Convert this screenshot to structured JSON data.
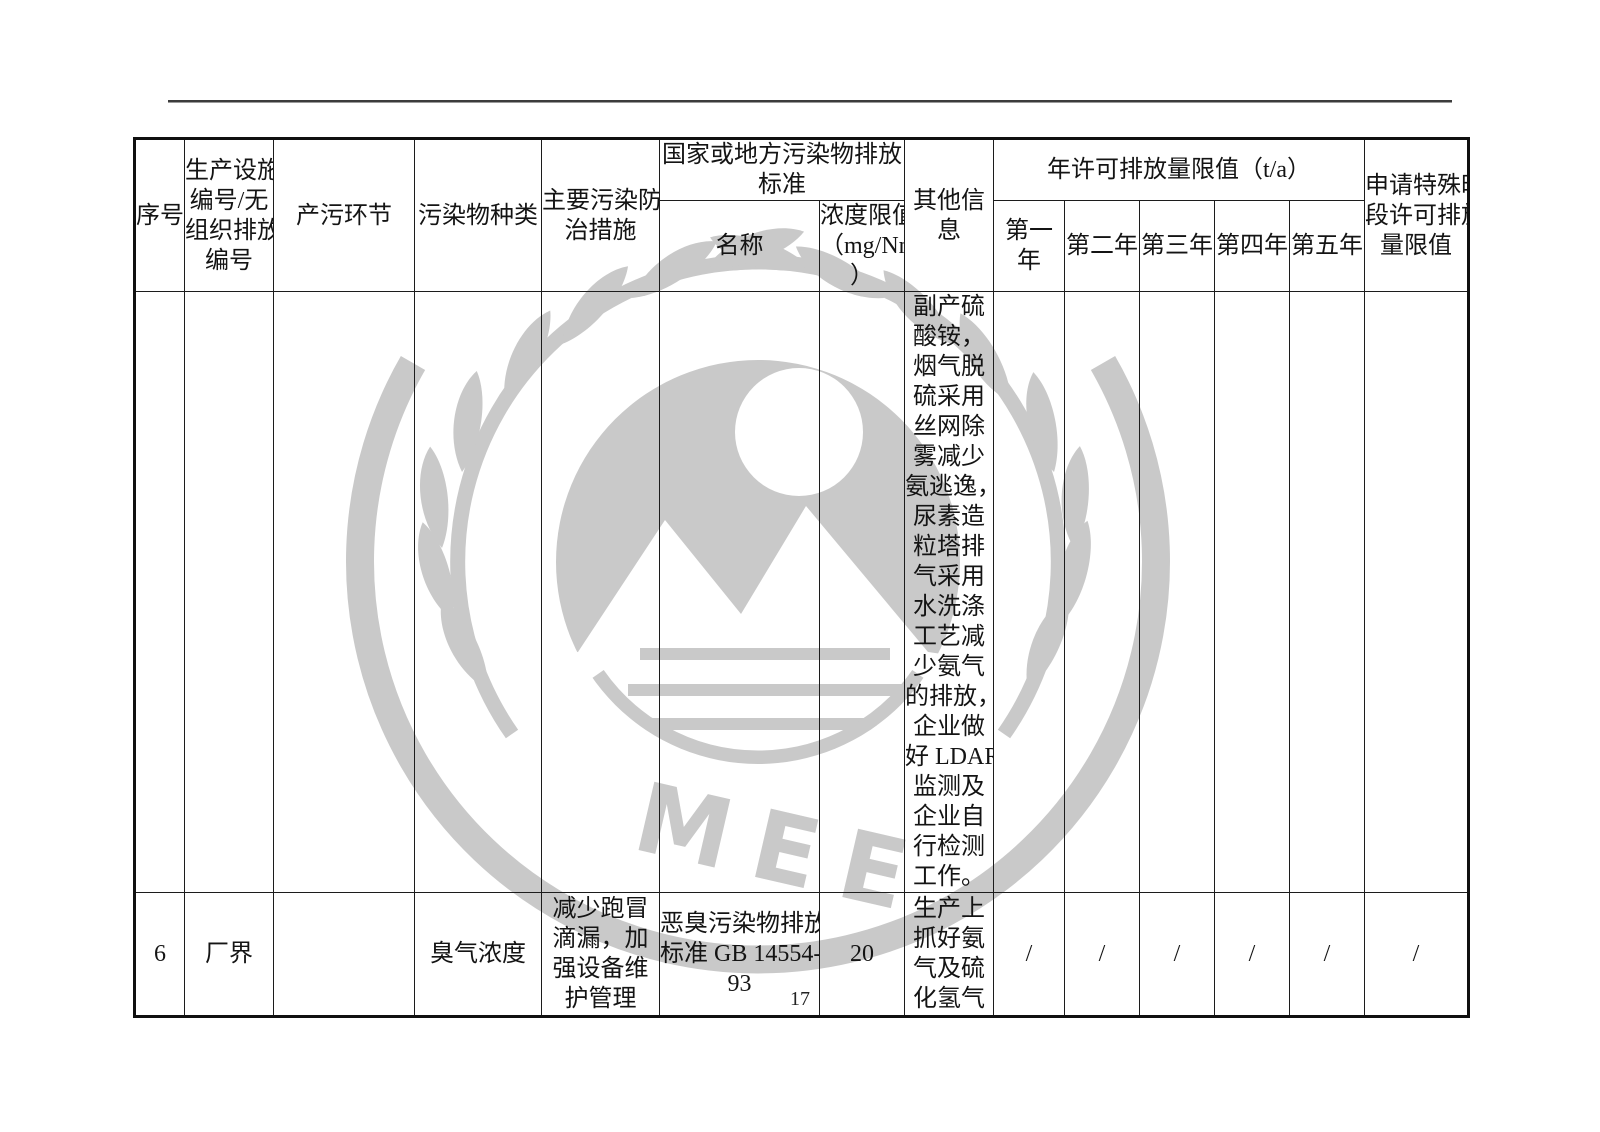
{
  "page": {
    "number": "17"
  },
  "watermark": {
    "letters": "MEE",
    "color": "#c9c9c9"
  },
  "table": {
    "header": {
      "col_index": "序号",
      "col_facility": "生产设施\n编号/无\n组织排放\n编号",
      "col_process": "产污环节",
      "col_pollutant": "污染物种类",
      "col_measures": "主要污染防\n治措施",
      "col_standard_group": "国家或地方污染物排放标准",
      "col_standard_name": "名称",
      "col_limit": "浓度限值\n（mg/Nm³\n）",
      "col_other": "其他信息",
      "col_annual_group": "年许可排放量限值（t/a）",
      "col_years": [
        "第一年",
        "第二年",
        "第三年",
        "第四年",
        "第五年"
      ],
      "col_special": "申请特殊时\n段许可排放\n量限值"
    },
    "rows": [
      {
        "index": "",
        "facility": "",
        "process": "",
        "pollutant": "",
        "measures": "",
        "standard_name": "",
        "limit": "",
        "other": "副产硫\n酸铵，\n烟气脱\n硫采用\n丝网除\n雾减少\n氨逃逸，\n尿素造\n粒塔排\n气采用\n水洗涤\n工艺减\n少氨气\n的排放，\n企业做\n好 LDAR\n监测及\n企业自\n行检测\n工作。",
        "years": [
          "",
          "",
          "",
          "",
          ""
        ],
        "special": ""
      },
      {
        "index": "6",
        "facility": "厂界",
        "process": "",
        "pollutant": "臭气浓度",
        "measures": "减少跑冒\n滴漏，加\n强设备维\n护管理",
        "standard_name": "恶臭污染物排放\n标准 GB 14554-\n93",
        "limit": "20",
        "other": "生产上\n抓好氨\n气及硫\n化氢气",
        "years": [
          "/",
          "/",
          "/",
          "/",
          "/"
        ],
        "special": "/"
      }
    ]
  }
}
